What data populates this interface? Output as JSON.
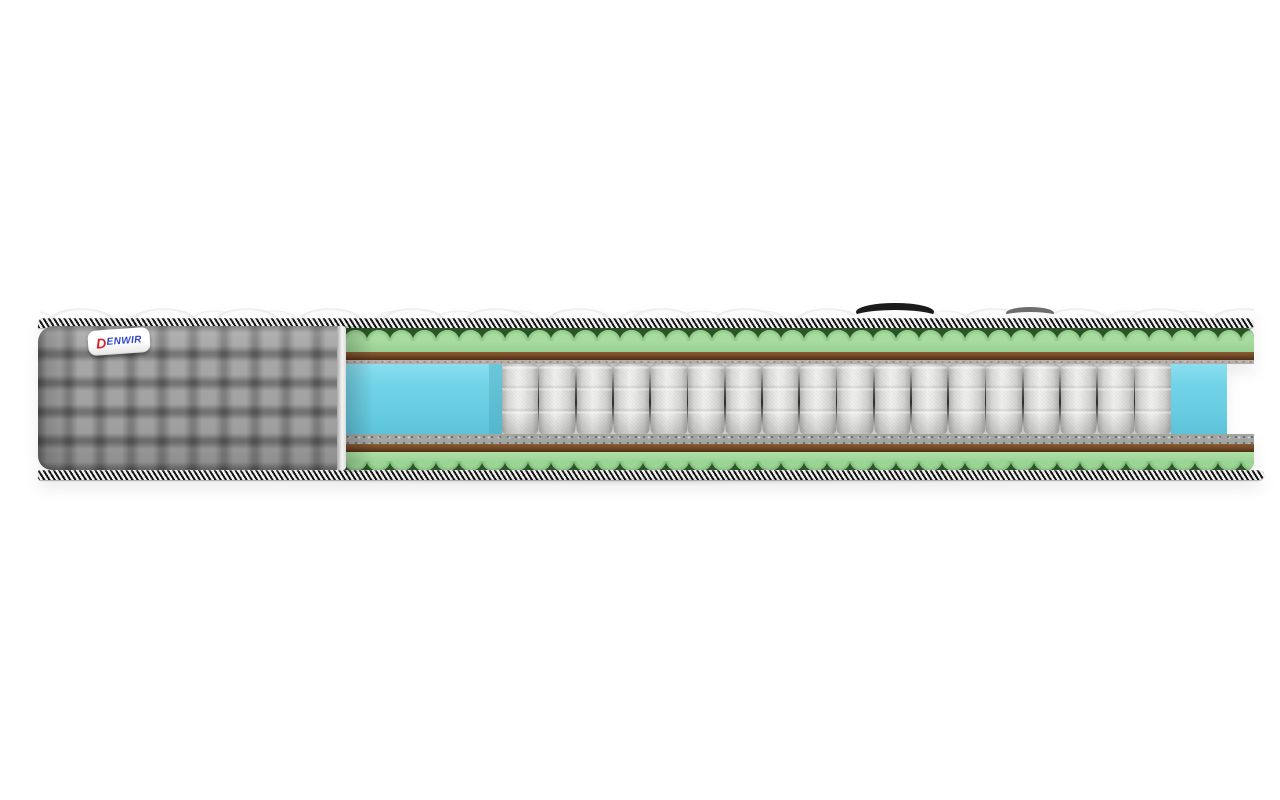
{
  "scene": {
    "type": "product-photo",
    "subject": "mattress cross-section cutaway",
    "background_color": "#ffffff"
  },
  "brand": {
    "initial": "D",
    "rest": "ENWIR",
    "initial_color": "#d8232b",
    "text_color": "#2f47c8",
    "label_background": "#ffffff"
  },
  "springs": {
    "count": 18
  },
  "palette": {
    "side_fabric_gray": "#949494",
    "piping_dark": "#151515",
    "piping_light": "#efefef",
    "foam_green_light": "#a8dba0",
    "foam_green_dark": "#2b5526",
    "coir_brown": "#6f4524",
    "felt_top_gray": "#b9aeac",
    "felt_bottom_gray": "#a2a6a3",
    "spring_white": "#efefed",
    "side_support_blue": "#72d3e8",
    "top_cover_white": "#fbfbfb"
  }
}
